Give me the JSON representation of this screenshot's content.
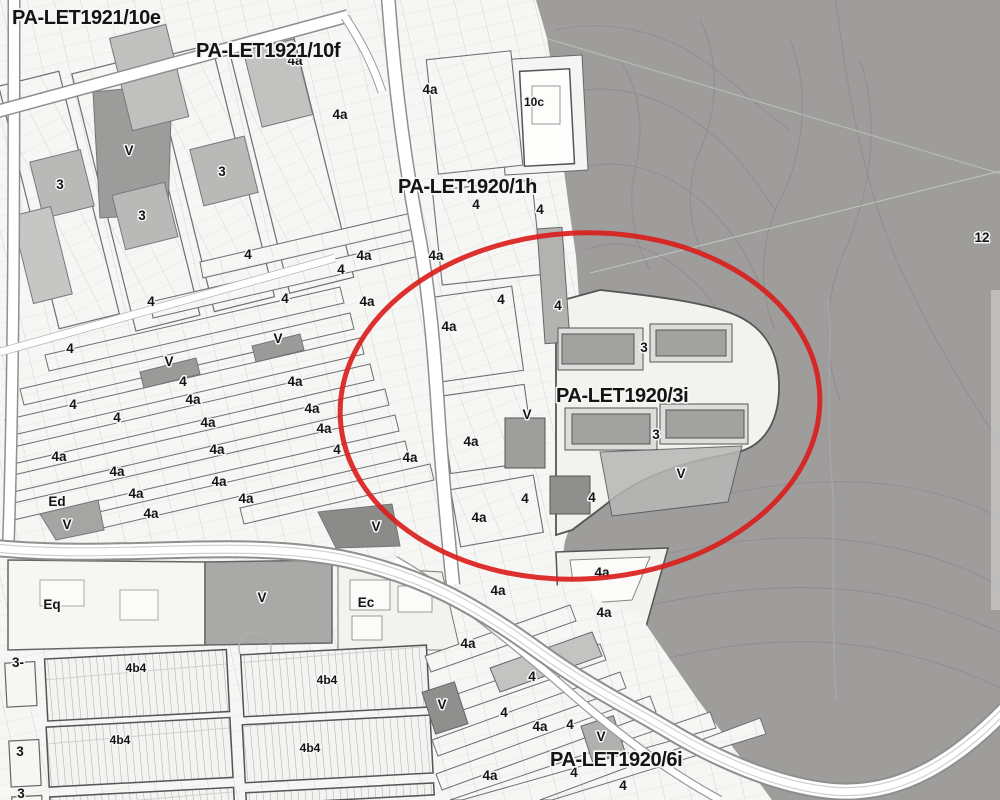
{
  "map": {
    "type": "municipal-zoning-plan-scan",
    "plan_labels": [
      {
        "text": "PA-LET1921/10e",
        "x": 12,
        "y": 24
      },
      {
        "text": "PA-LET1921/10f",
        "x": 196,
        "y": 57
      },
      {
        "text": "PA-LET1920/1h",
        "x": 398,
        "y": 193
      },
      {
        "text": "PA-LET1920/3i",
        "x": 556,
        "y": 402
      },
      {
        "text": "PA-LET1920/6i",
        "x": 550,
        "y": 766
      }
    ],
    "zone_labels": [
      {
        "t": "4a",
        "x": 295,
        "y": 60
      },
      {
        "t": "4a",
        "x": 430,
        "y": 89
      },
      {
        "t": "10c",
        "x": 534,
        "y": 101
      },
      {
        "t": "4a",
        "x": 340,
        "y": 114
      },
      {
        "t": "V",
        "x": 129,
        "y": 150
      },
      {
        "t": "3",
        "x": 60,
        "y": 184
      },
      {
        "t": "3",
        "x": 222,
        "y": 171
      },
      {
        "t": "3",
        "x": 142,
        "y": 215
      },
      {
        "t": "4",
        "x": 248,
        "y": 254
      },
      {
        "t": "4",
        "x": 476,
        "y": 204
      },
      {
        "t": "4",
        "x": 540,
        "y": 209
      },
      {
        "t": "4",
        "x": 151,
        "y": 301
      },
      {
        "t": "4",
        "x": 285,
        "y": 298
      },
      {
        "t": "4a",
        "x": 364,
        "y": 255
      },
      {
        "t": "4a",
        "x": 436,
        "y": 255
      },
      {
        "t": "4",
        "x": 341,
        "y": 269
      },
      {
        "t": "4a",
        "x": 367,
        "y": 301
      },
      {
        "t": "4",
        "x": 501,
        "y": 299
      },
      {
        "t": "4",
        "x": 558,
        "y": 305
      },
      {
        "t": "V",
        "x": 278,
        "y": 338
      },
      {
        "t": "4",
        "x": 70,
        "y": 348
      },
      {
        "t": "V",
        "x": 169,
        "y": 361
      },
      {
        "t": "4",
        "x": 183,
        "y": 381
      },
      {
        "t": "4a",
        "x": 295,
        "y": 381
      },
      {
        "t": "4a",
        "x": 449,
        "y": 326
      },
      {
        "t": "3",
        "x": 644,
        "y": 347
      },
      {
        "t": "4a",
        "x": 193,
        "y": 399
      },
      {
        "t": "4",
        "x": 73,
        "y": 404
      },
      {
        "t": "4",
        "x": 117,
        "y": 417
      },
      {
        "t": "4a",
        "x": 312,
        "y": 408
      },
      {
        "t": "4a",
        "x": 208,
        "y": 422
      },
      {
        "t": "4a",
        "x": 324,
        "y": 428
      },
      {
        "t": "V",
        "x": 527,
        "y": 414
      },
      {
        "t": "4a",
        "x": 59,
        "y": 456
      },
      {
        "t": "4a",
        "x": 217,
        "y": 449
      },
      {
        "t": "4a",
        "x": 471,
        "y": 441
      },
      {
        "t": "4",
        "x": 337,
        "y": 449
      },
      {
        "t": "4a",
        "x": 410,
        "y": 457
      },
      {
        "t": "4a",
        "x": 117,
        "y": 471
      },
      {
        "t": "4a",
        "x": 219,
        "y": 481
      },
      {
        "t": "3",
        "x": 656,
        "y": 434
      },
      {
        "t": "V",
        "x": 681,
        "y": 473
      },
      {
        "t": "4a",
        "x": 136,
        "y": 493
      },
      {
        "t": "4a",
        "x": 246,
        "y": 498
      },
      {
        "t": "4",
        "x": 525,
        "y": 498
      },
      {
        "t": "4",
        "x": 592,
        "y": 497
      },
      {
        "t": "Ed",
        "x": 57,
        "y": 501
      },
      {
        "t": "4a",
        "x": 151,
        "y": 513
      },
      {
        "t": "4a",
        "x": 479,
        "y": 517
      },
      {
        "t": "V",
        "x": 376,
        "y": 526
      },
      {
        "t": "V",
        "x": 67,
        "y": 524
      },
      {
        "t": "4a",
        "x": 602,
        "y": 572
      },
      {
        "t": "4a",
        "x": 498,
        "y": 590
      },
      {
        "t": "4a",
        "x": 604,
        "y": 612
      },
      {
        "t": "Eq",
        "x": 52,
        "y": 604
      },
      {
        "t": "V",
        "x": 262,
        "y": 597
      },
      {
        "t": "Ec",
        "x": 366,
        "y": 602
      },
      {
        "t": "4a",
        "x": 468,
        "y": 643
      },
      {
        "t": "3-",
        "x": 18,
        "y": 662
      },
      {
        "t": "4b4",
        "x": 136,
        "y": 667
      },
      {
        "t": "4b4",
        "x": 327,
        "y": 679
      },
      {
        "t": "4",
        "x": 532,
        "y": 676
      },
      {
        "t": "V",
        "x": 442,
        "y": 704
      },
      {
        "t": "4",
        "x": 504,
        "y": 712
      },
      {
        "t": "4a",
        "x": 540,
        "y": 726
      },
      {
        "t": "4",
        "x": 570,
        "y": 724
      },
      {
        "t": "V",
        "x": 601,
        "y": 736
      },
      {
        "t": "3",
        "x": 20,
        "y": 751
      },
      {
        "t": "4b4",
        "x": 120,
        "y": 739
      },
      {
        "t": "4b4",
        "x": 310,
        "y": 747
      },
      {
        "t": "12",
        "x": 982,
        "y": 237
      },
      {
        "t": "4",
        "x": 574,
        "y": 772
      },
      {
        "t": "4a",
        "x": 490,
        "y": 775
      },
      {
        "t": "4",
        "x": 623,
        "y": 785
      },
      {
        "t": "3",
        "x": 21,
        "y": 793
      }
    ],
    "highlight": {
      "shape": "ellipse",
      "cx": 580,
      "cy": 406,
      "rx": 240,
      "ry": 173,
      "rotation": -3,
      "color": "#d9201d",
      "stroke_width": 5
    },
    "colors": {
      "background": "#fafaf8",
      "hill": "#9e9d9b",
      "contour": "#8a8287",
      "parcel_line": "#d4d4d2",
      "block_outline": "#6f6f6f",
      "building_dark": "#a2a2a0",
      "shade_mid": "#b9b9b7",
      "shade_dark": "#9a9a98",
      "road": "#ffffff",
      "label": "#141414"
    }
  }
}
